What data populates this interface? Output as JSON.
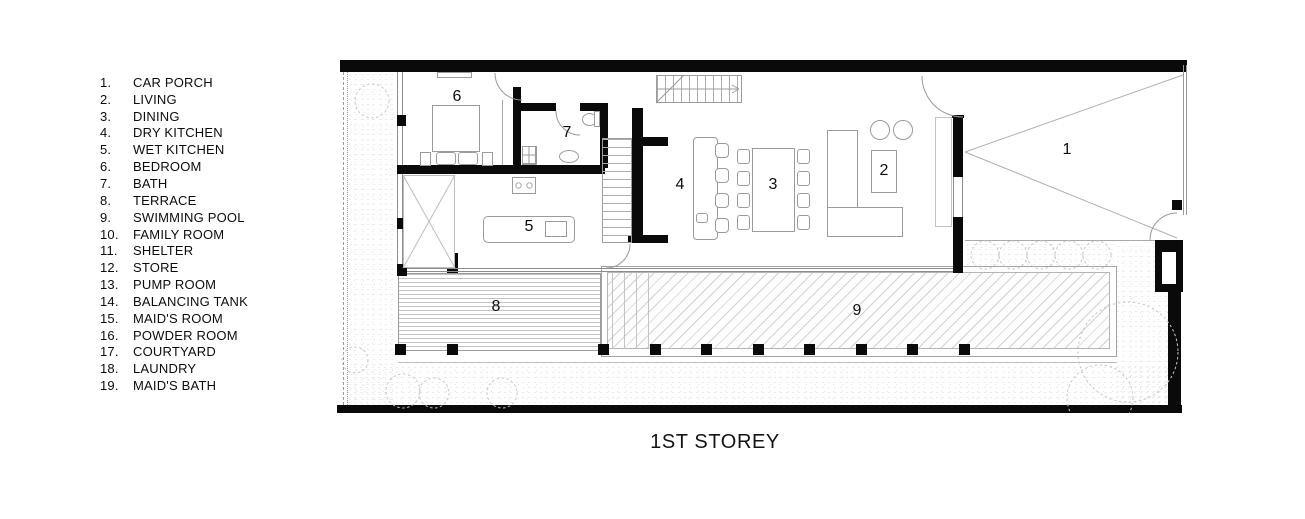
{
  "title": "1ST STOREY",
  "legend": {
    "items": [
      {
        "num": "1.",
        "label": "CAR PORCH"
      },
      {
        "num": "2.",
        "label": "LIVING"
      },
      {
        "num": "3.",
        "label": "DINING"
      },
      {
        "num": "4.",
        "label": "DRY KITCHEN"
      },
      {
        "num": "5.",
        "label": "WET KITCHEN"
      },
      {
        "num": "6.",
        "label": "BEDROOM"
      },
      {
        "num": "7.",
        "label": "BATH"
      },
      {
        "num": "8.",
        "label": "TERRACE"
      },
      {
        "num": "9.",
        "label": "SWIMMING POOL"
      },
      {
        "num": "10.",
        "label": "FAMILY ROOM"
      },
      {
        "num": "11.",
        "label": "SHELTER"
      },
      {
        "num": "12.",
        "label": "STORE"
      },
      {
        "num": "13.",
        "label": "PUMP ROOM"
      },
      {
        "num": "14.",
        "label": "BALANCING TANK"
      },
      {
        "num": "15.",
        "label": "MAID'S ROOM"
      },
      {
        "num": "16.",
        "label": "POWDER ROOM"
      },
      {
        "num": "17.",
        "label": "COURTYARD"
      },
      {
        "num": "18.",
        "label": "LAUNDRY"
      },
      {
        "num": "19.",
        "label": "MAID'S BATH"
      }
    ]
  },
  "plan": {
    "room_labels": [
      {
        "num": "1",
        "name": "car-porch"
      },
      {
        "num": "2",
        "name": "living"
      },
      {
        "num": "3",
        "name": "dining"
      },
      {
        "num": "4",
        "name": "dry-kitchen"
      },
      {
        "num": "5",
        "name": "wet-kitchen"
      },
      {
        "num": "6",
        "name": "bedroom"
      },
      {
        "num": "7",
        "name": "bath"
      },
      {
        "num": "8",
        "name": "terrace"
      },
      {
        "num": "9",
        "name": "swimming-pool"
      }
    ]
  },
  "colors": {
    "wall": "#0a0a0a",
    "thin_line": "#9b9b9b",
    "paper": "#ffffff"
  }
}
